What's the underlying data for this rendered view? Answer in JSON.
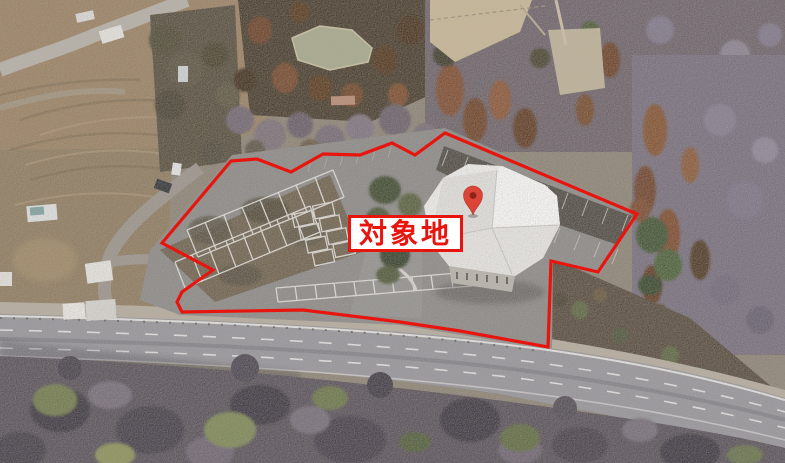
{
  "annotation": {
    "site_label": "対象地",
    "boundary_points": "162,243 231,161 257,159 291,172 323,154 360,155 392,143 415,155 445,133 637,214 598,272 551,261 548,347 460,331 400,322 303,310 182,312 177,302 182,292 213,270",
    "boundary_color": "#e8150f",
    "label_text_color": "#e8150f",
    "label_background": "#ffffff",
    "pin": {
      "transform": "translate(473,215)",
      "color": "#dc4437",
      "hole_color": "#8d241a"
    }
  }
}
